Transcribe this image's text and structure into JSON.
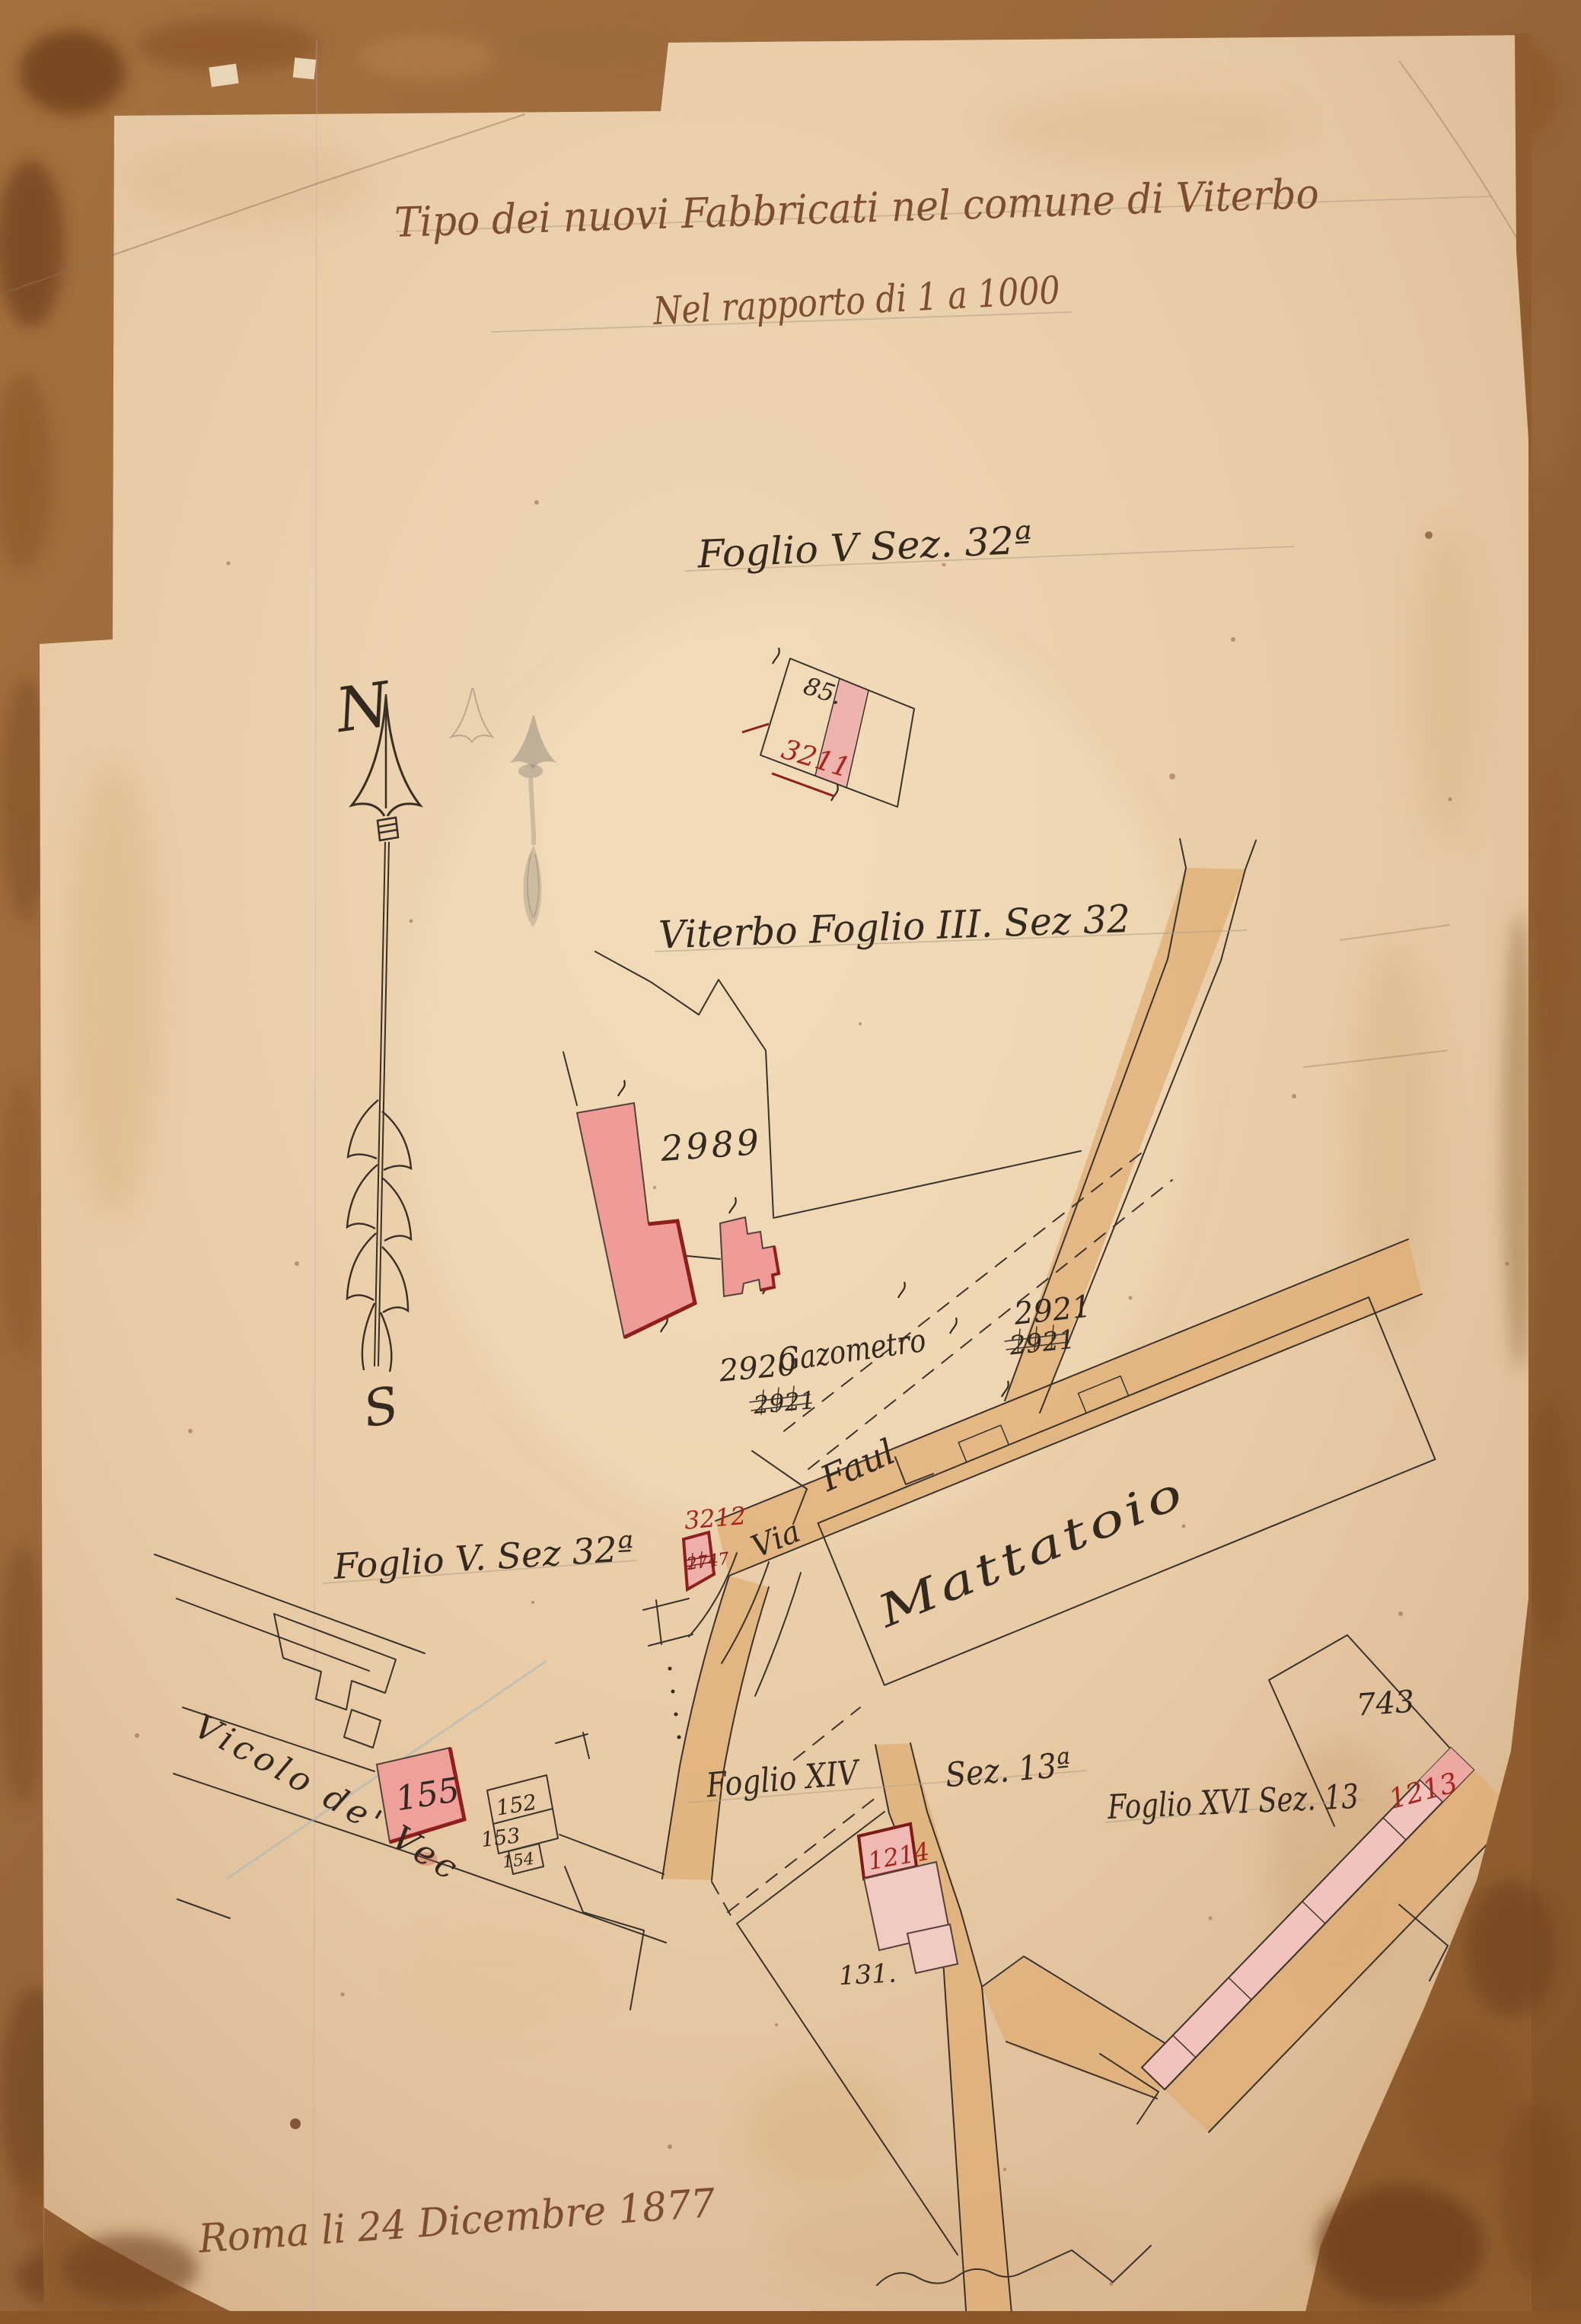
{
  "artifact": {
    "title_line1": "Tipo dei nuovi Fabbricati nel comune di Viterbo",
    "title_line2": "Nel rapporto di 1 a 1000",
    "date_line": "Roma li 24 Dicembre 1877"
  },
  "compass": {
    "north": "N",
    "south": "S"
  },
  "sheet_labels": {
    "foglio_v_top": "Foglio V Sez. 32ª",
    "viterbo_foglio_iii": "Viterbo Foglio III. Sez 32",
    "foglio_v_left": "Foglio V. Sez 32ª",
    "foglio_xiv": "Foglio XIV",
    "sez_13a": "Sez. 13ª",
    "foglio_xvi_sez_13": "Foglio XVI Sez. 13"
  },
  "streets": {
    "via": "Via",
    "faul": "Faul",
    "vicolo_de_vecchi": "Vicolo de' Vecchi"
  },
  "features": {
    "mattatoio": "Mattatoio",
    "gazometro": "Gazometro"
  },
  "parcels": {
    "p85": "85.",
    "p3211": "3211",
    "p2989": "2989",
    "p2920": "2920",
    "p2920_struck": "2921",
    "p2921": "2921",
    "p2921_struck": "2921",
    "p3212": "3212",
    "p3212_struck": "2747",
    "p155": "155",
    "p152": "152",
    "p153": "153",
    "p154": "154",
    "p131": "131.",
    "p1214": "1214",
    "p743": "743",
    "p1213": "1213"
  },
  "colors": {
    "paper": "#e9cfae",
    "board": "#9a6a3a",
    "ink": "#33291f",
    "script_brown": "#7d4e2e",
    "building_red": "#ef9b97",
    "building_red_dark": "#8e1f1c",
    "label_red": "#a8251e",
    "road_tan": "#dfae74"
  }
}
